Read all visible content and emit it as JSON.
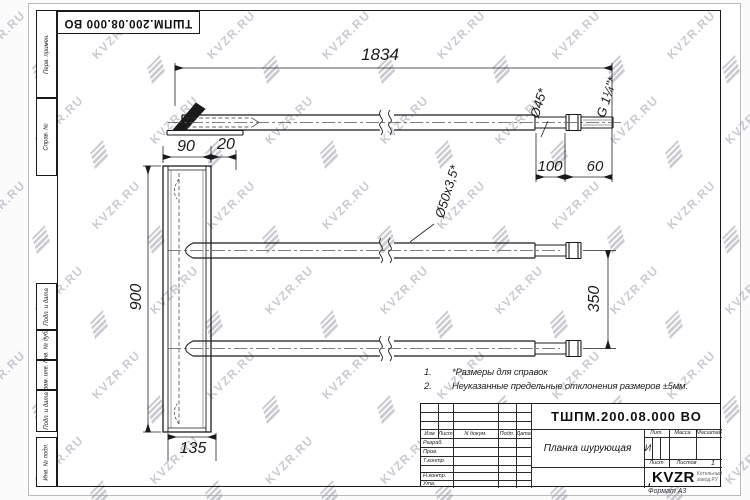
{
  "watermark": {
    "text": "KVZR.RU"
  },
  "stamp": {
    "code": "ТШПМ.200.08.000 ВО"
  },
  "margin": {
    "perv": "Перв. примен.",
    "sprav": "Справ. №",
    "podp1": "Подп. и дата",
    "inv_dubl": "Инв. № дубл.",
    "vzam": "Взам. инв. №",
    "podp2": "Подп. и дата",
    "inv_podl": "Инв. № подл."
  },
  "dims": {
    "overall": "1834",
    "plate_w": "90",
    "offset": "20",
    "height": "900",
    "spacing": "350",
    "end_turn": "100",
    "thread_len": "60",
    "foot": "135",
    "tube": "Ø50x3,5*",
    "end_dia": "Ø45*",
    "thread": "G 1¼\"*"
  },
  "notes": {
    "n1": "1.",
    "t1": "*Размеры для справок",
    "n2": "2.",
    "t2": "Неуказанные предельные отклонения размеров ±5мм."
  },
  "title_block": {
    "code": "ТШПМ.200.08.000 ВО",
    "name": "Планка шурующая",
    "h_izm": "Изм",
    "h_list": "Лист",
    "h_ndok": "N докум.",
    "h_podp": "Подп.",
    "h_data": "Дата",
    "r_razrab": "Разраб.",
    "r_prov": "Пров.",
    "r_tkontr": "Т.контр.",
    "r_nkontr": "Н.контр.",
    "r_utv": "Утв.",
    "h_lit": "Лит.",
    "h_massa": "Масса",
    "h_masshtab": "Масштаб",
    "lit": "И",
    "h_list2": "Лист",
    "h_listov": "Листов",
    "listov": "1",
    "logo": "KVZR",
    "logo_sub1": "Котельный",
    "logo_sub2": "завод.РУ",
    "format": "Формат А3"
  }
}
